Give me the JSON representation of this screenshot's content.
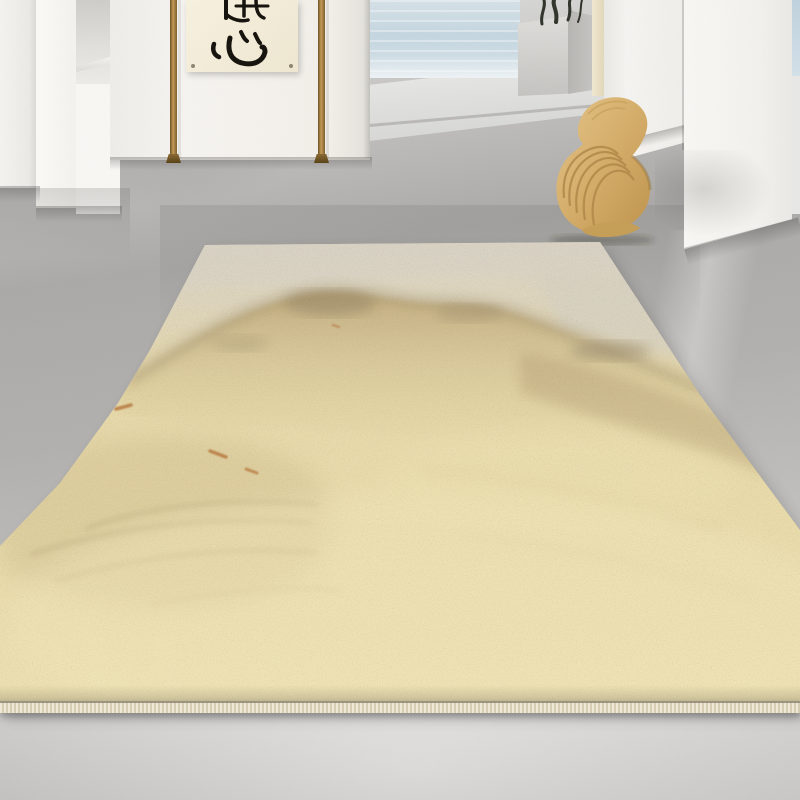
{
  "scene": {
    "aria": {
      "room": "Minimalist white concrete interior with sea view",
      "floor": "Polished gray concrete floor",
      "walls": "White plaster wall panels with recessed niche",
      "sea": "Pale blue sea visible beyond the terrace",
      "deck": "Light concrete terrace deck with step edge",
      "scroll": "Hanging calligraphy scroll between two wooden poles",
      "planter": "Concrete planter with dark dry branches",
      "pillar": "Cream pillar beside the planter",
      "chair": "Sculptural curved bentwood chair with layered laminations",
      "rug": "Large abstract watercolor shag rug in cream, beige, tan and rust",
      "binding": "Cream serged edge binding along the front of the rug"
    }
  },
  "scroll": {
    "calligraphy_text": "隨心",
    "writing_mode": "vertical"
  },
  "palette": {
    "rug_cream": "#e9dcab",
    "rug_greige": "#dcd6c8",
    "rug_tan": "#c3ad7c",
    "rug_taupe": "#9c8c6c",
    "rug_rust": "#b97a40",
    "rug_binding": "#ebe3ce",
    "floor_gray": "#b2b1af",
    "wall_white": "#f5f4f1",
    "sea_blue": "#c5d6e0",
    "pole_wood": "#c49b55",
    "chair_wood": "#d3ab67",
    "ink_black": "#17130e"
  }
}
